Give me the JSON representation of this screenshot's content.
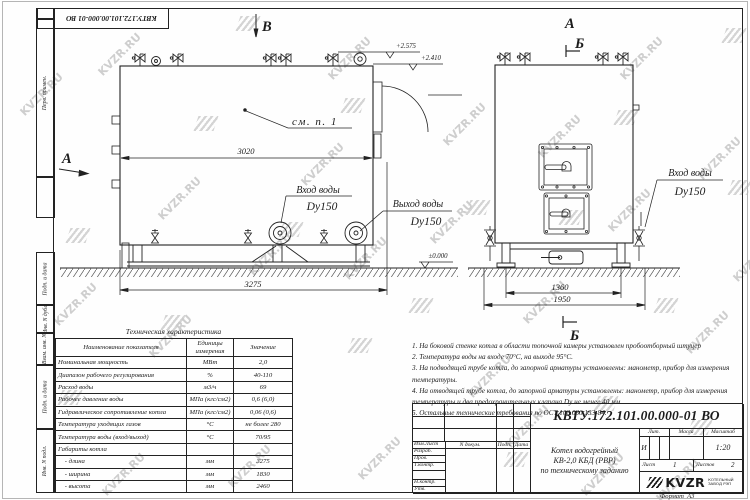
{
  "watermark": {
    "text": "KVZR.RU"
  },
  "corner_stamp": {
    "doc_number": "КВТУ.172.101.00.000-01 ВО"
  },
  "margin_labels": [
    "Перв. примен.",
    "Подп. и дата",
    "Инв. N дубл.",
    "Взам. инв. N",
    "Подп. и дата",
    "Инв. N подл."
  ],
  "drawing": {
    "view_a_left": "А",
    "view_b_top": "В",
    "view_a_right": "А",
    "section_b_top": "Б",
    "section_b_bottom": "Б",
    "callout_note": "см. п. 1",
    "inlet_label": "Вход воды",
    "inlet_dn": "Dy150",
    "outlet_label": "Выход воды",
    "outlet_dn": "Dy150",
    "inlet_right_label": "Вход воды",
    "inlet_right_dn": "Dy150",
    "elev_top1": "+2.575",
    "elev_top2": "+2.410",
    "elev_zero": "±0.000",
    "dim_block_length": "3020",
    "dim_total_length": "3275",
    "dim_support_width": "1360",
    "dim_total_width": "1950"
  },
  "tech_table": {
    "title": "Техническая характеристика",
    "headers": [
      "Наименование показателя",
      "Единицы измерения",
      "Значение"
    ],
    "rows": [
      [
        "Номинальная мощность",
        "МВт",
        "2,0"
      ],
      [
        "Диапазон рабочего регулирования",
        "%",
        "40-110"
      ],
      [
        "Расход воды",
        "м3/ч",
        "69"
      ],
      [
        "Рабочее давление воды",
        "МПа (кгс/см2)",
        "0,6 (6,0)"
      ],
      [
        "Гидравлическое сопротивление котла",
        "МПа (кгс/см2)",
        "0,06 (0,6)"
      ],
      [
        "Температура уходящих газов",
        "°С",
        "не более 280"
      ],
      [
        "Температура воды (вход/выход)",
        "°С",
        "70/95"
      ],
      [
        "Габариты котла",
        "",
        ""
      ],
      [
        "    - длина",
        "мм",
        "3275"
      ],
      [
        "    - ширина",
        "мм",
        "1830"
      ],
      [
        "    - высота",
        "мм",
        "2460"
      ]
    ]
  },
  "notes": [
    "1.  На боковой стенке котла в области топочной камеры установлен пробоотборный штуцер",
    "2.  Температура воды на входе  70°С,  на выходе  95°С.",
    "3.  На подводящей трубе котла, до запорной арматуры установлены:  манометр,  прибор для измерения температуры.",
    "4.  На отводящей трубе котла, до запорной арматуры установлены:  манометр,  прибор для измерения температуры и два предохранительных клапана  Dy не менее  40 мм.",
    "5.  Остальные технические требования по ОСТ  108.030.133-84."
  ],
  "title_block": {
    "doc_number": "КВТУ.172.101.00.000-01 ВО",
    "cols": [
      "Изм.Лист",
      "N докум.",
      "Подп.",
      "Дата"
    ],
    "rows": [
      "Разраб.",
      "Пров.",
      "Т.контр.",
      "",
      "Н.контр.",
      "Утв."
    ],
    "product_lines": [
      "Котел водогрейный",
      "КВ-2,0 КБД (РВР)",
      "по техническому заданию"
    ],
    "lit_label": "Лит.",
    "mass_label": "Масса",
    "scale_label": "Масштаб",
    "lit_value": "И",
    "scale_value": "1:20",
    "sheet_label": "Лист",
    "sheet_value": "1",
    "sheets_label": "Листов",
    "sheets_value": "2",
    "logo_text": "KVZR",
    "logo_sub_lines": [
      "КОТЕЛЬНЫЙ",
      "ЗАВОД РЭП"
    ]
  },
  "format_label": "Формат  А3"
}
